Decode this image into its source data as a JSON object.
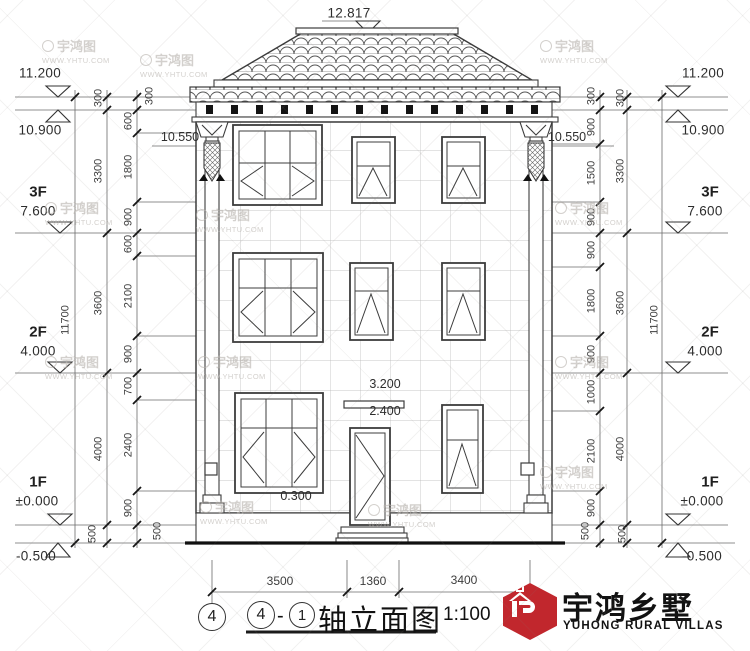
{
  "watermark": {
    "brand": "宇鸿图",
    "url": "WWW.YHTU.COM"
  },
  "logo": {
    "cn": "宇鸿乡墅",
    "en": "YUHONG RURAL VILLAS",
    "accent": "#c1272d"
  },
  "titlebar": {
    "axis_bubble": "4",
    "axis_from": "4",
    "separator": "-",
    "axis_to": "1",
    "name": "轴立面图",
    "scale": "1:100"
  },
  "levels": {
    "ridge": "12.817",
    "left": [
      {
        "floor": "",
        "value": "11.200"
      },
      {
        "floor": "",
        "value": "10.900"
      },
      {
        "floor": "3F",
        "value": "7.600"
      },
      {
        "floor": "2F",
        "value": "4.000"
      },
      {
        "floor": "1F",
        "value": "±0.000"
      },
      {
        "floor": "",
        "value": "-0.500"
      }
    ],
    "right": [
      {
        "floor": "",
        "value": "11.200"
      },
      {
        "floor": "",
        "value": "10.900"
      },
      {
        "floor": "3F",
        "value": "7.600"
      },
      {
        "floor": "2F",
        "value": "4.000"
      },
      {
        "floor": "1F",
        "value": "±0.000"
      },
      {
        "floor": "",
        "value": "-0.500"
      }
    ],
    "annotations": {
      "cornice_left": "10.550",
      "cornice_right": "10.550",
      "canopy_top": "3.200",
      "door_top": "2.400",
      "sill": "0.300"
    }
  },
  "dimensions": {
    "left": {
      "overall": "11700",
      "floors": [
        "300",
        "3300",
        "3600",
        "4000",
        "500"
      ],
      "detail": [
        "300",
        "600",
        "1800",
        "900",
        "600",
        "2100",
        "900",
        "700",
        "2400",
        "900",
        "500"
      ]
    },
    "right": {
      "overall": "11700",
      "floors": [
        "300",
        "3300",
        "3600",
        "4000",
        "500"
      ],
      "detail": [
        "300",
        "900",
        "1500",
        "900",
        "900",
        "1800",
        "900",
        "1000",
        "2100",
        "900",
        "500"
      ]
    },
    "bottom": [
      "3500",
      "1360",
      "3400"
    ]
  }
}
